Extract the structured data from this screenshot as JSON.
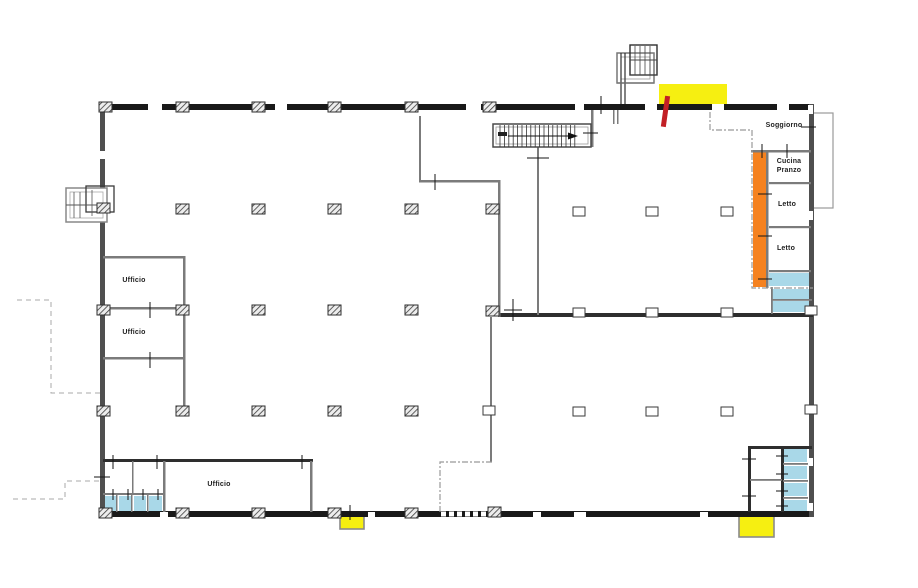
{
  "page": {
    "background": "#ffffff"
  },
  "floor_plan": {
    "canvas": {
      "w": 918,
      "h": 588
    },
    "colors": {
      "wall_dark": "#191919",
      "wall_mid": "#4f4f4f",
      "wall_gray": "#7b7b7b",
      "wall_dark2": "#2e2e2e",
      "highlight_yellow": "#F6EF11",
      "highlight_orange": "#F58220",
      "highlight_cyan": "#A9D8E8",
      "marker_red": "#C22026",
      "dash_gray": "#999999",
      "dash_light": "#aaaaaa",
      "text": "#1f1f1f"
    },
    "labels": [
      {
        "id": "soggiorno",
        "text": "Soggiorno",
        "x": 752,
        "y": 121,
        "w": 64
      },
      {
        "id": "cucina-pranzo",
        "text": "Cucina Pranzo",
        "x": 772,
        "y": 157,
        "w": 34
      },
      {
        "id": "letto-1",
        "text": "Letto",
        "x": 764,
        "y": 200,
        "w": 46
      },
      {
        "id": "letto-2",
        "text": "Letto",
        "x": 763,
        "y": 244,
        "w": 46
      },
      {
        "id": "ufficio-1",
        "text": "Ufficio",
        "x": 104,
        "y": 276,
        "w": 60
      },
      {
        "id": "ufficio-2",
        "text": "Ufficio",
        "x": 104,
        "y": 328,
        "w": 60
      },
      {
        "id": "ufficio-3",
        "text": "Ufficio",
        "x": 189,
        "y": 480,
        "w": 60
      }
    ],
    "walls": [
      [
        100,
        104,
        713,
        6,
        "dk"
      ],
      [
        100,
        511,
        713,
        6,
        "dk"
      ],
      [
        100,
        104,
        5,
        413,
        "md"
      ],
      [
        809,
        104,
        5,
        413,
        "md"
      ],
      [
        498,
        313,
        315,
        4,
        "d2"
      ],
      [
        103,
        459,
        210,
        3,
        "d2"
      ],
      [
        748,
        446,
        64,
        3,
        "d2"
      ],
      [
        748,
        446,
        3,
        66,
        "d2"
      ],
      [
        781,
        448,
        3,
        64,
        "d2"
      ],
      [
        419,
        116,
        2,
        66,
        "gr"
      ],
      [
        419,
        180,
        81,
        2.5,
        "gr"
      ],
      [
        498,
        180,
        2.5,
        137,
        "gr"
      ],
      [
        537,
        146,
        2,
        169,
        "gr"
      ],
      [
        490,
        317,
        2,
        145,
        "gr"
      ],
      [
        310,
        461,
        2.5,
        51,
        "gr"
      ],
      [
        163,
        461,
        2.5,
        51,
        "gr"
      ],
      [
        132,
        461,
        1.5,
        33,
        "gr"
      ],
      [
        103,
        493,
        61,
        2,
        "gr"
      ],
      [
        116,
        494,
        1.5,
        18,
        "gr"
      ],
      [
        131,
        494,
        1.5,
        18,
        "gr"
      ],
      [
        147,
        494,
        1.5,
        18,
        "gr"
      ],
      [
        103,
        256,
        82,
        2.5,
        "gr"
      ],
      [
        103,
        307,
        82,
        2.5,
        "gr"
      ],
      [
        103,
        357,
        82,
        2.5,
        "gr"
      ],
      [
        183,
        256,
        2.5,
        157,
        "gr"
      ],
      [
        591,
        110,
        2.5,
        37,
        "gr"
      ],
      [
        578,
        144,
        14,
        2,
        "gr"
      ],
      [
        613,
        110,
        1.5,
        14,
        "gr"
      ],
      [
        617,
        110,
        1.5,
        14,
        "gr"
      ],
      [
        751,
        150,
        60,
        2.5,
        "gr"
      ],
      [
        766,
        150,
        2.5,
        138,
        "gr"
      ],
      [
        769,
        182,
        42,
        2.2,
        "gr"
      ],
      [
        769,
        226,
        42,
        2.2,
        "gr"
      ],
      [
        769,
        270,
        42,
        2.2,
        "gr"
      ],
      [
        771,
        287,
        1.8,
        27,
        "gr"
      ],
      [
        771,
        299,
        41,
        1.8,
        "gr"
      ],
      [
        750,
        479,
        32,
        1.8,
        "gr"
      ],
      [
        783,
        463,
        25,
        1.8,
        "gr"
      ],
      [
        783,
        480,
        25,
        1.8,
        "gr"
      ],
      [
        783,
        497,
        25,
        1.8,
        "gr"
      ]
    ],
    "highlights": [
      [
        659,
        84,
        68,
        21,
        "highlight_yellow",
        0
      ],
      [
        340,
        512,
        24,
        17,
        "highlight_yellow",
        1
      ],
      [
        739,
        514,
        35,
        23,
        "highlight_yellow",
        1
      ],
      [
        753,
        152,
        14,
        135,
        "highlight_orange",
        0
      ],
      [
        769,
        273,
        43,
        13,
        "highlight_cyan",
        0
      ],
      [
        772,
        289,
        39,
        11,
        "highlight_cyan",
        0
      ],
      [
        772,
        301,
        40,
        11,
        "highlight_cyan",
        0
      ],
      [
        784,
        449,
        23,
        13,
        "highlight_cyan",
        0
      ],
      [
        784,
        466,
        23,
        13,
        "highlight_cyan",
        0
      ],
      [
        784,
        483,
        23,
        13,
        "highlight_cyan",
        0
      ],
      [
        784,
        500,
        23,
        11,
        "highlight_cyan",
        0
      ],
      [
        104,
        496,
        12,
        16,
        "highlight_cyan",
        0
      ],
      [
        119,
        496,
        12,
        16,
        "highlight_cyan",
        0
      ],
      [
        134,
        496,
        12,
        16,
        "highlight_cyan",
        0
      ],
      [
        149,
        496,
        13,
        16,
        "highlight_cyan",
        0
      ]
    ],
    "hatched_columns": [
      [
        99,
        102
      ],
      [
        176,
        102
      ],
      [
        252,
        102
      ],
      [
        328,
        102
      ],
      [
        405,
        102
      ],
      [
        483,
        102
      ],
      [
        97,
        203
      ],
      [
        97,
        305
      ],
      [
        97,
        406
      ],
      [
        176,
        204
      ],
      [
        252,
        204
      ],
      [
        328,
        204
      ],
      [
        405,
        204
      ],
      [
        486,
        204
      ],
      [
        176,
        305
      ],
      [
        252,
        305
      ],
      [
        328,
        305
      ],
      [
        405,
        305
      ],
      [
        486,
        306
      ],
      [
        176,
        406
      ],
      [
        252,
        406
      ],
      [
        328,
        406
      ],
      [
        405,
        406
      ],
      [
        99,
        508
      ],
      [
        176,
        508
      ],
      [
        252,
        508
      ],
      [
        328,
        508
      ],
      [
        405,
        508
      ],
      [
        488,
        507
      ]
    ],
    "open_columns": [
      [
        573,
        207
      ],
      [
        646,
        207
      ],
      [
        721,
        207
      ],
      [
        573,
        308
      ],
      [
        646,
        308
      ],
      [
        721,
        308
      ],
      [
        483,
        406
      ],
      [
        573,
        407
      ],
      [
        646,
        407
      ],
      [
        721,
        407
      ],
      [
        805,
        306
      ],
      [
        805,
        405
      ]
    ],
    "window_gaps": [
      [
        148,
        104,
        14,
        6
      ],
      [
        275,
        104,
        12,
        6
      ],
      [
        466,
        104,
        15,
        6
      ],
      [
        575,
        104,
        9,
        6
      ],
      [
        645,
        104,
        12,
        6
      ],
      [
        712,
        104,
        12,
        6
      ],
      [
        777,
        104,
        12,
        6
      ],
      [
        160,
        512,
        8,
        5
      ],
      [
        368,
        512,
        7,
        5
      ],
      [
        533,
        512,
        8,
        5
      ],
      [
        574,
        512,
        12,
        5
      ],
      [
        700,
        512,
        8,
        5
      ],
      [
        100,
        151,
        5,
        8
      ],
      [
        808,
        105,
        5,
        9
      ],
      [
        808,
        211,
        5,
        9
      ],
      [
        808,
        458,
        5,
        8
      ],
      [
        808,
        503,
        5,
        8
      ]
    ],
    "door_ticks": [
      [
        150,
        302,
        150,
        318
      ],
      [
        150,
        352,
        150,
        368
      ],
      [
        113,
        455,
        113,
        469
      ],
      [
        157,
        455,
        157,
        469
      ],
      [
        302,
        455,
        302,
        469
      ],
      [
        113,
        489,
        113,
        500
      ],
      [
        128,
        489,
        128,
        500
      ],
      [
        143,
        489,
        143,
        500
      ],
      [
        158,
        489,
        158,
        500
      ],
      [
        601,
        96,
        601,
        114
      ],
      [
        435,
        174,
        435,
        190
      ],
      [
        527,
        158,
        549,
        158
      ],
      [
        583,
        133,
        598,
        133
      ],
      [
        513,
        299,
        513,
        321
      ],
      [
        504,
        310,
        522,
        310
      ],
      [
        350,
        505,
        350,
        520
      ],
      [
        762,
        144,
        762,
        158
      ],
      [
        787,
        144,
        787,
        158
      ],
      [
        758,
        194,
        772,
        194
      ],
      [
        758,
        236,
        772,
        236
      ],
      [
        758,
        279,
        772,
        279
      ],
      [
        742,
        459,
        756,
        459
      ],
      [
        742,
        496,
        756,
        496
      ],
      [
        776,
        456,
        788,
        456
      ],
      [
        776,
        474,
        788,
        474
      ],
      [
        776,
        491,
        788,
        491
      ],
      [
        776,
        506,
        788,
        506
      ],
      [
        801,
        127,
        816,
        127
      ],
      [
        94,
        477,
        110,
        477
      ]
    ],
    "unit_boundary_dashes": [
      "710,112 710,130 752,130 752,288 813,288",
      "492,462 440,462 440,513"
    ],
    "property_dashes": [
      "17,300 51,300 51,393 103,393",
      "13,499 65,499 65,481 103,481"
    ],
    "balcony": {
      "x": 813,
      "y": 113,
      "w": 20,
      "h": 95
    },
    "staircase": {
      "box": [
        493,
        124,
        98,
        23
      ],
      "inner": [
        496,
        127,
        92,
        17
      ],
      "tread_x0": 500,
      "tread_n": 18,
      "tread_dx": 4.4,
      "tread_y1": 125,
      "tread_y2": 147,
      "arrow": [
        508,
        136,
        569,
        136
      ],
      "head": "578,136 568,132.5 568,139.5",
      "start": [
        498,
        132,
        9,
        4
      ]
    },
    "detail_shapes": [
      {
        "k": "r",
        "x": 617,
        "y": 53,
        "w": 37,
        "h": 30,
        "s": "#777777",
        "sw": 1.5,
        "f": "#ffffff"
      },
      {
        "k": "r",
        "x": 621,
        "y": 57,
        "w": 29,
        "h": 22,
        "s": "#999999",
        "sw": 0.8,
        "f": "none"
      },
      {
        "k": "r",
        "x": 630,
        "y": 45,
        "w": 27,
        "h": 30,
        "s": "#2f2f2f",
        "sw": 1.4,
        "f": "none"
      },
      {
        "k": "l",
        "x1": 635,
        "y1": 46,
        "x2": 635,
        "y2": 75,
        "s": "#444444",
        "sw": 0.8
      },
      {
        "k": "l",
        "x1": 640,
        "y1": 46,
        "x2": 640,
        "y2": 75,
        "s": "#444444",
        "sw": 0.8
      },
      {
        "k": "l",
        "x1": 645,
        "y1": 46,
        "x2": 645,
        "y2": 75,
        "s": "#444444",
        "sw": 0.8
      },
      {
        "k": "l",
        "x1": 650,
        "y1": 46,
        "x2": 650,
        "y2": 75,
        "s": "#444444",
        "sw": 0.8
      },
      {
        "k": "l",
        "x1": 630,
        "y1": 60,
        "x2": 657,
        "y2": 60,
        "s": "#444444",
        "sw": 1
      },
      {
        "k": "l",
        "x1": 630,
        "y1": 75,
        "x2": 657,
        "y2": 75,
        "s": "#444444",
        "sw": 0.8
      },
      {
        "k": "l",
        "x1": 621,
        "y1": 53,
        "x2": 621,
        "y2": 104,
        "s": "#2f2f2f",
        "sw": 1.2
      },
      {
        "k": "l",
        "x1": 625,
        "y1": 53,
        "x2": 625,
        "y2": 104,
        "s": "#2f2f2f",
        "sw": 1.2
      },
      {
        "k": "l",
        "x1": 617,
        "y1": 83,
        "x2": 654,
        "y2": 83,
        "s": "#777777",
        "sw": 1.2
      },
      {
        "k": "r",
        "x": 66,
        "y": 188,
        "w": 41,
        "h": 34,
        "s": "#888888",
        "sw": 1.5,
        "f": "#ffffff"
      },
      {
        "k": "r",
        "x": 70,
        "y": 192,
        "w": 33,
        "h": 26,
        "s": "#aaaaaa",
        "sw": 0.8,
        "f": "none"
      },
      {
        "k": "r",
        "x": 86,
        "y": 186,
        "w": 28,
        "h": 26,
        "s": "#3a3a3a",
        "sw": 1.3,
        "f": "none"
      },
      {
        "k": "l",
        "x1": 74,
        "y1": 192,
        "x2": 74,
        "y2": 218,
        "s": "#555555",
        "sw": 0.8
      },
      {
        "k": "l",
        "x1": 80,
        "y1": 192,
        "x2": 80,
        "y2": 218,
        "s": "#555555",
        "sw": 0.8
      },
      {
        "k": "l",
        "x1": 66,
        "y1": 205,
        "x2": 107,
        "y2": 205,
        "s": "#555555",
        "sw": 1
      },
      {
        "k": "l",
        "x1": 92,
        "y1": 190,
        "x2": 92,
        "y2": 216,
        "s": "#555555",
        "sw": 0.8
      },
      {
        "k": "l",
        "x1": 441,
        "y1": 514,
        "x2": 491,
        "y2": 514,
        "s": "#ffffff",
        "sw": 5,
        "da": "5 3"
      }
    ],
    "red_marker": {
      "x": 665,
      "y": 96,
      "w": 5,
      "h": 31,
      "rot": 8,
      "cx": 667,
      "cy": 97
    }
  }
}
